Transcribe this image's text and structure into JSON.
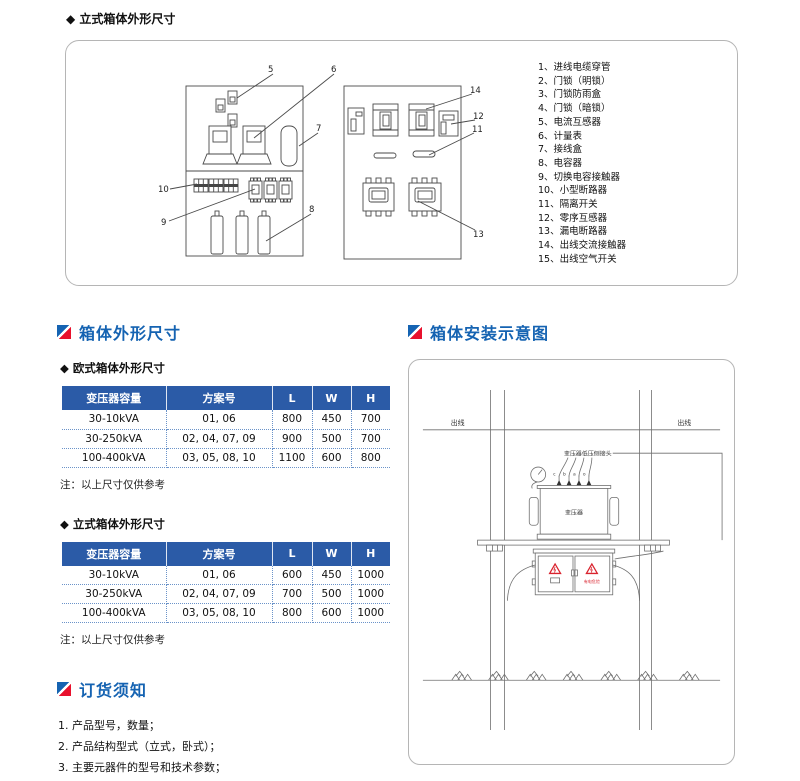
{
  "colors": {
    "accent_blue": "#1563b2",
    "accent_red": "#e8112d",
    "table_header_bg": "#2b5ba7",
    "warning_red": "#d9232e"
  },
  "vertical_dims": {
    "title": "◆ 立式箱体外形尺寸",
    "legend": [
      "1、进线电缆穿管",
      "2、门锁（明锁）",
      "3、门锁防雨盒",
      "4、门锁（暗锁）",
      "5、电流互感器",
      "6、计量表",
      "7、接线盒",
      "8、电容器",
      "9、切换电容接触器",
      "10、小型断路器",
      "11、隔离开关",
      "12、零序互感器",
      "13、漏电断路器",
      "14、出线交流接触器",
      "15、出线空气开关"
    ],
    "callouts": {
      "c5": "5",
      "c6": "6",
      "c7": "7",
      "c8": "8",
      "c9": "9",
      "c10": "10",
      "c11": "11",
      "c12": "12",
      "c13": "13",
      "c14": "14"
    }
  },
  "dims_section": {
    "heading": "箱体外形尺寸",
    "eu_subheading": "◆ 欧式箱体外形尺寸",
    "vertical_subheading": "◆ 立式箱体外形尺寸",
    "note": "注：以上尺寸仅供参考",
    "headers": {
      "capacity": "变压器容量",
      "scheme": "方案号",
      "l": "L",
      "w": "W",
      "h": "H"
    },
    "eu_rows": [
      {
        "capacity": "30-10kVA",
        "scheme": "01, 06",
        "l": "800",
        "w": "450",
        "h": "700"
      },
      {
        "capacity": "30-250kVA",
        "scheme": "02, 04, 07, 09",
        "l": "900",
        "w": "500",
        "h": "700"
      },
      {
        "capacity": "100-400kVA",
        "scheme": "03, 05, 08, 10",
        "l": "1100",
        "w": "600",
        "h": "800"
      }
    ],
    "v_rows": [
      {
        "capacity": "30-10kVA",
        "scheme": "01, 06",
        "l": "600",
        "w": "450",
        "h": "1000"
      },
      {
        "capacity": "30-250kVA",
        "scheme": "02, 04, 07, 09",
        "l": "700",
        "w": "500",
        "h": "1000"
      },
      {
        "capacity": "100-400kVA",
        "scheme": "03, 05, 08, 10",
        "l": "800",
        "w": "600",
        "h": "1000"
      }
    ]
  },
  "order_section": {
    "heading": "订货须知",
    "items": [
      "1. 产品型号，数量；",
      "2. 产品结构型式（立式，卧式）；",
      "3. 主要元器件的型号和技术参数；",
      "4. 其它特殊要求。"
    ]
  },
  "install_section": {
    "heading": "箱体安装示意图",
    "labels": {
      "outline_left": "出线",
      "outline_right": "出线",
      "lv_terminal": "变压器低压侧接头",
      "transformer": "变压器",
      "danger": "有电危险",
      "bushing_a": "c",
      "bushing_b": "b",
      "bushing_c": "a",
      "bushing_d": "o"
    }
  }
}
